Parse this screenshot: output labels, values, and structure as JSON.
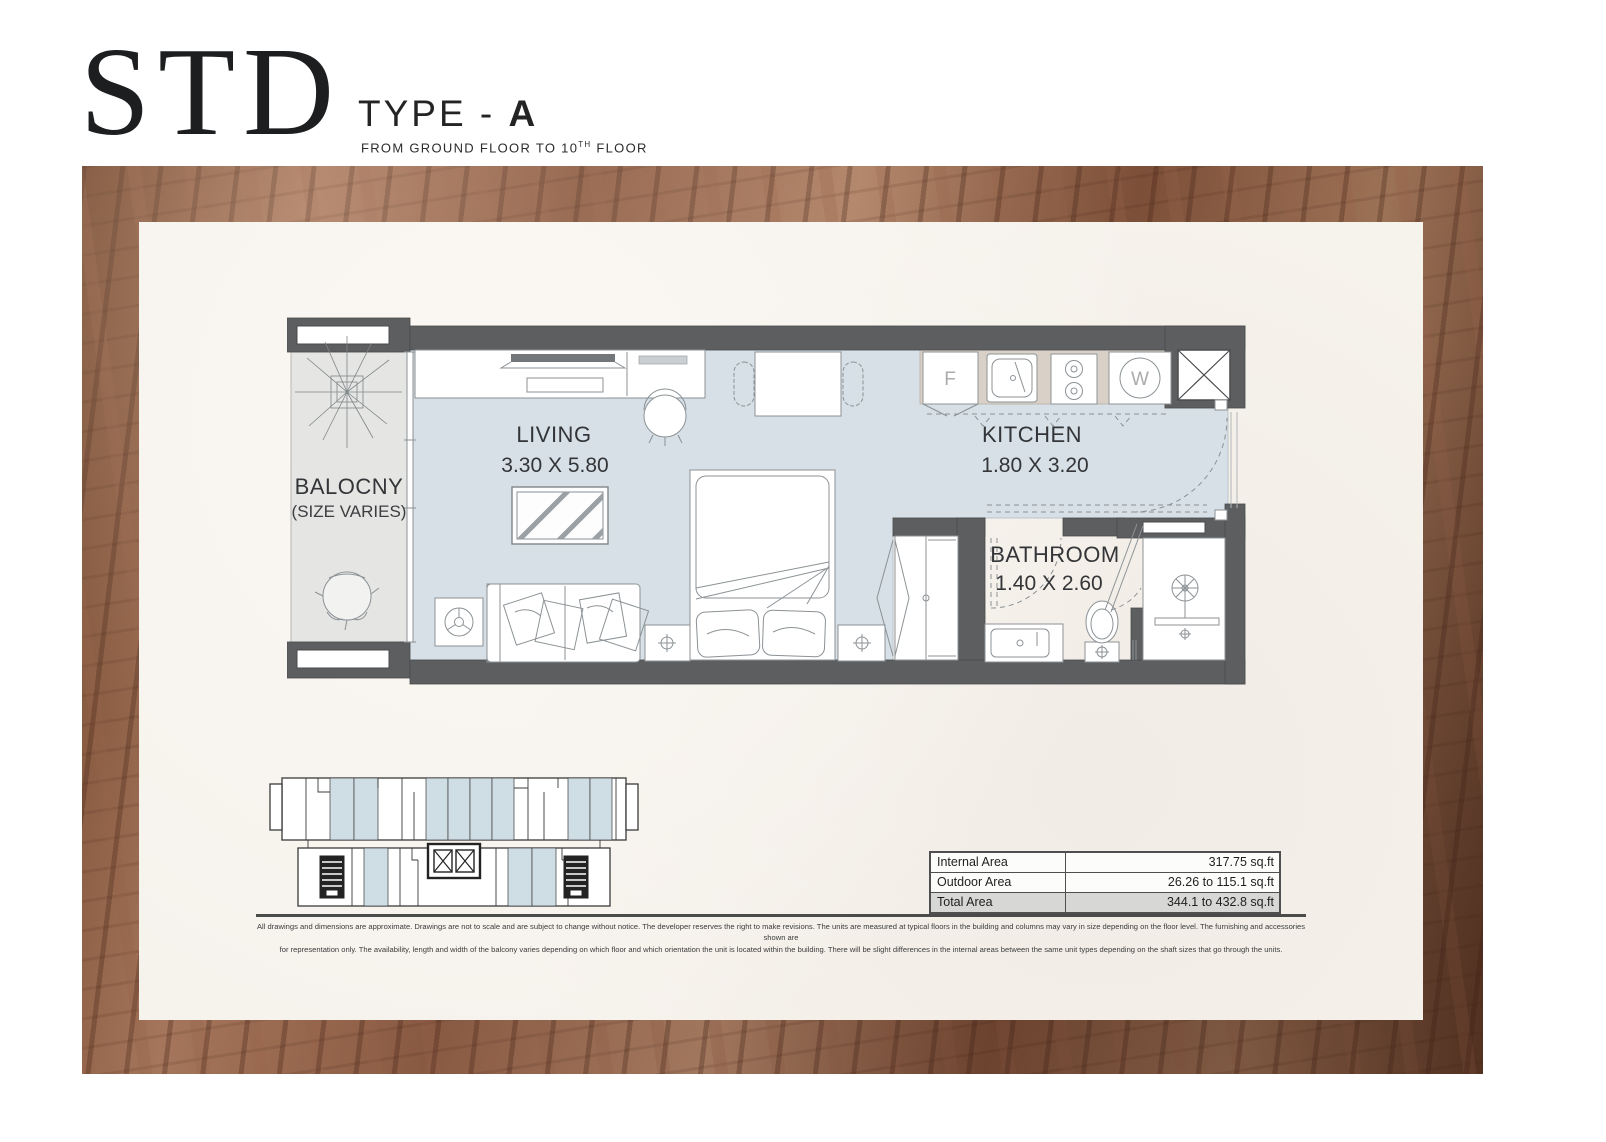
{
  "header": {
    "title": "STD",
    "type_label": "TYPE - ",
    "type_value": "A",
    "subtitle_prefix": "FROM GROUND FLOOR TO 10",
    "subtitle_sup": "TH",
    "subtitle_suffix": " FLOOR"
  },
  "plan": {
    "balcony": {
      "name": "BALOCNY",
      "note": "(SIZE VARIES)"
    },
    "living": {
      "name": "LIVING",
      "dims": "3.30 X 5.80"
    },
    "kitchen": {
      "name": "KITCHEN",
      "dims": "1.80 X 3.20"
    },
    "bathroom": {
      "name": "BATHROOM",
      "dims": "1.40 X 2.60"
    },
    "appliances": {
      "fridge": "F",
      "washer": "W"
    }
  },
  "area_table": {
    "rows": [
      {
        "label": "Internal Area",
        "value": "317.75 sq.ft"
      },
      {
        "label": "Outdoor Area",
        "value": "26.26 to 115.1 sq.ft"
      },
      {
        "label": "Total Area",
        "value": "344.1 to 432.8 sq.ft"
      }
    ]
  },
  "disclaimer": {
    "line1": "All drawings and dimensions are approximate. Drawings are not to scale and are subject to change without notice. The developer reserves the right to make revisions. The units are measured at typical floors in the building and columns may vary in size depending on the floor level. The furnishing and accessories shown are",
    "line2": "for representation only. The availability, length and width of the balcony varies depending on which floor and which orientation the unit is located within the building. There will be slight differences in the internal areas between the same unit types depending on the shaft sizes that go through the units."
  },
  "colors": {
    "wall_gray": "#5d5e60",
    "floor_blue": "#d6e0e6",
    "balcony_gray": "#e5e5e3",
    "counter_tan": "#d9d1c8",
    "keyplan_highlight": "#cfdde4",
    "panel_cream": "#f6f2ec",
    "wood_brown": "#8a5a42"
  }
}
